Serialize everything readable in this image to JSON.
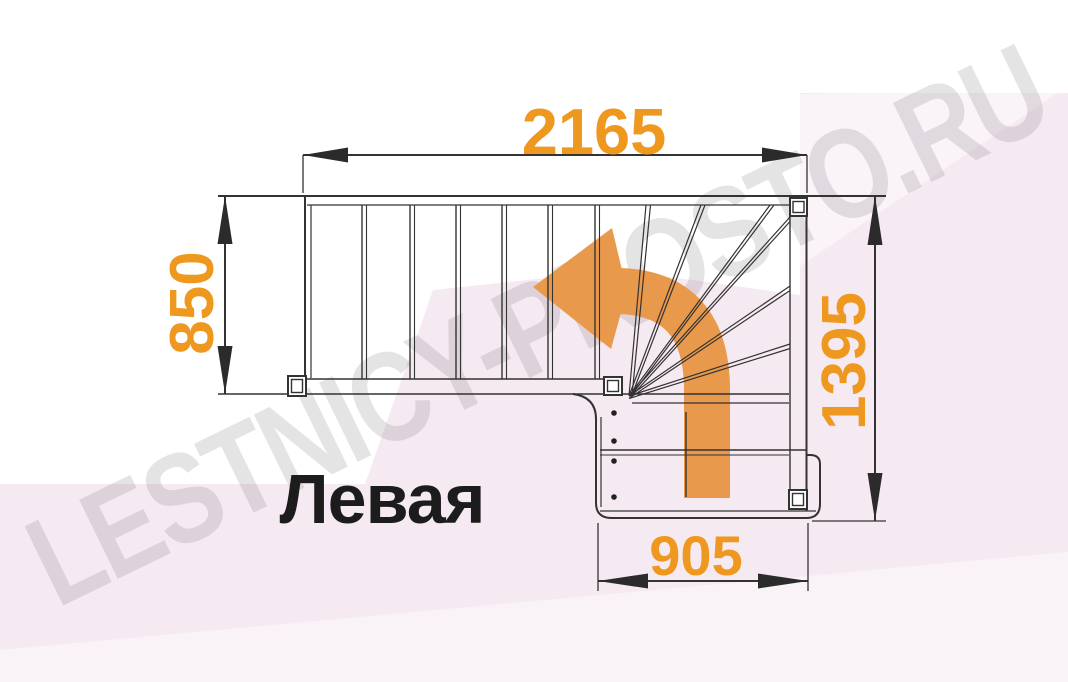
{
  "diagram": {
    "type": "staircase-floor-plan",
    "title": "Левая",
    "watermark": "LESTNICY-PROSTO.RU",
    "dimensions_mm": {
      "top_width": "2165",
      "left_depth": "850",
      "right_depth": "1395",
      "bottom_width": "905"
    },
    "stair": {
      "straight_treads": 7,
      "winder_treads": 6,
      "lower_flight_treads": 2,
      "newel_posts": 4,
      "turn_direction": "left"
    },
    "colors": {
      "dimension_text": "#EF981F",
      "direction_arrow": "#E9994C",
      "line": "#333333",
      "background_tint": "#F6EAF2",
      "watermark": "#E2E0E2"
    }
  }
}
